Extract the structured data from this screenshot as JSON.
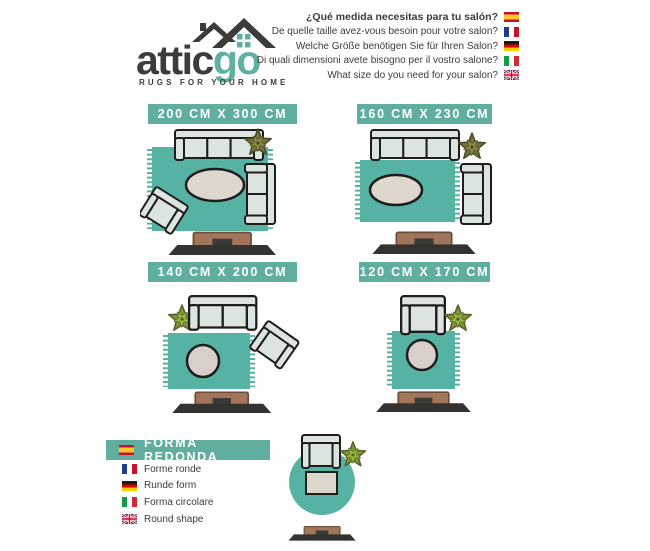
{
  "logo": {
    "brand_attic": "attic",
    "brand_go": "go",
    "tagline": "RUGS FOR YOUR HOME"
  },
  "header": {
    "questions": [
      {
        "lang": "es",
        "flag": "spain-flag",
        "text": "¿Qué medida necesitas para tu salón?"
      },
      {
        "lang": "fr",
        "flag": "france-flag",
        "text": "De quelle taille avez-vous besoin pour votre salon?"
      },
      {
        "lang": "de",
        "flag": "germany-flag",
        "text": "Welche Größe benötigen Sie für Ihren Salon?"
      },
      {
        "lang": "it",
        "flag": "italy-flag",
        "text": "Di quali dimensioni avete bisogno per il vostro salone?"
      },
      {
        "lang": "en",
        "flag": "uk-flag",
        "text": "What size do you need for your salon?"
      }
    ]
  },
  "sizes": [
    {
      "label": "200 CM X 300 CM"
    },
    {
      "label": "160 CM X 230 CM"
    },
    {
      "label": "140 CM X 200 CM"
    },
    {
      "label": "120 CM X 170 CM"
    }
  ],
  "round_section": {
    "title": "FORMA REDONDA",
    "title_flag": "spain-flag",
    "translations": [
      {
        "lang": "fr",
        "flag": "france-flag",
        "text": "Forme ronde"
      },
      {
        "lang": "de",
        "flag": "germany-flag",
        "text": "Runde form"
      },
      {
        "lang": "it",
        "flag": "italy-flag",
        "text": "Forma circolare"
      },
      {
        "lang": "en",
        "flag": "uk-flag",
        "text": "Round shape"
      }
    ]
  },
  "colors": {
    "teal_banner": "#60AEA0",
    "teal_rug": "#56B3A3",
    "dark_text": "#3C3C3B",
    "outline": "#1D1D1B",
    "sofa_fill": "#DCE4E0",
    "wood": "#A3765B",
    "tv": "#333332"
  }
}
